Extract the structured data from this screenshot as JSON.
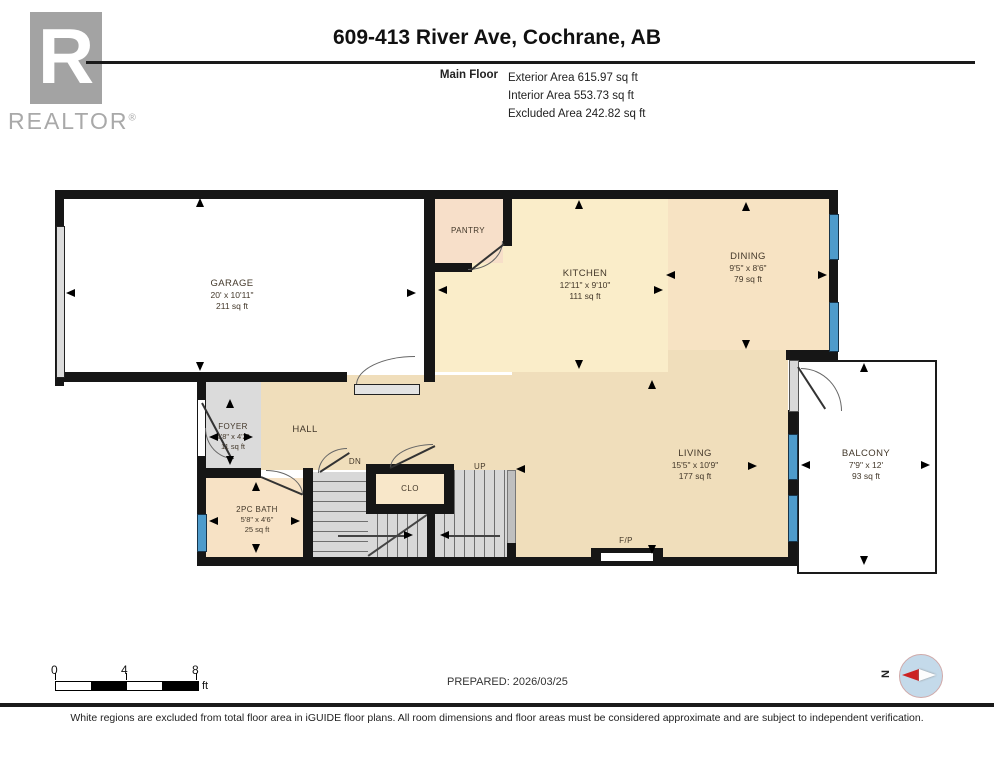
{
  "header": {
    "logo_letter": "R",
    "logo_text": "REALTOR",
    "logo_reg": "®",
    "title": "609-413 River Ave, Cochrane, AB",
    "floor_label": "Main Floor",
    "stats": [
      "Exterior Area 615.97 sq ft",
      "Interior Area 553.73 sq ft",
      "Excluded Area 242.82 sq ft"
    ]
  },
  "rooms": {
    "garage": {
      "name": "GARAGE",
      "dims": "20' x 10'11\"",
      "area": "211 sq ft"
    },
    "kitchen": {
      "name": "KITCHEN",
      "dims": "12'11\" x 9'10\"",
      "area": "111 sq ft"
    },
    "dining": {
      "name": "DINING",
      "dims": "9'5\" x 8'6\"",
      "area": "79 sq ft"
    },
    "living": {
      "name": "LIVING",
      "dims": "15'5\" x 10'9\"",
      "area": "177 sq ft"
    },
    "balcony": {
      "name": "BALCONY",
      "dims": "7'9\" x 12'",
      "area": "93 sq ft"
    },
    "foyer": {
      "name": "FOYER",
      "dims": "2'8\" x 4'2\"",
      "area": "11 sq ft"
    },
    "bath": {
      "name": "2PC BATH",
      "dims": "5'8\" x 4'6\"",
      "area": "25 sq ft"
    },
    "pantry": {
      "name": "PANTRY"
    },
    "hall": {
      "name": "HALL"
    },
    "closet": {
      "name": "CLO"
    },
    "stairs": {
      "up": "UP",
      "down": "DN"
    },
    "fireplace": {
      "label": "F/P"
    }
  },
  "footer": {
    "scale": {
      "t0": "0",
      "t4": "4",
      "t8": "8",
      "unit": "ft"
    },
    "prepared": "PREPARED: 2026/03/25",
    "compass_n": "N",
    "disclaimer": "White regions are excluded from total floor area in iGUIDE floor plans. All room dimensions and floor areas must be considered approximate and are subject to independent verification."
  },
  "colors": {
    "wall": "#161616",
    "window_blue": "#4e9bcb",
    "kitchen_cream": "#faedc9",
    "living_tan": "#f0debb",
    "pantry_peach": "#f7dfc9",
    "bath_peach": "#f7e2c5",
    "stair_gray": "#d8d8d8",
    "compass_blue": "#c4daea",
    "compass_red": "#cc2222",
    "logo_gray": "#a3a3a3"
  }
}
